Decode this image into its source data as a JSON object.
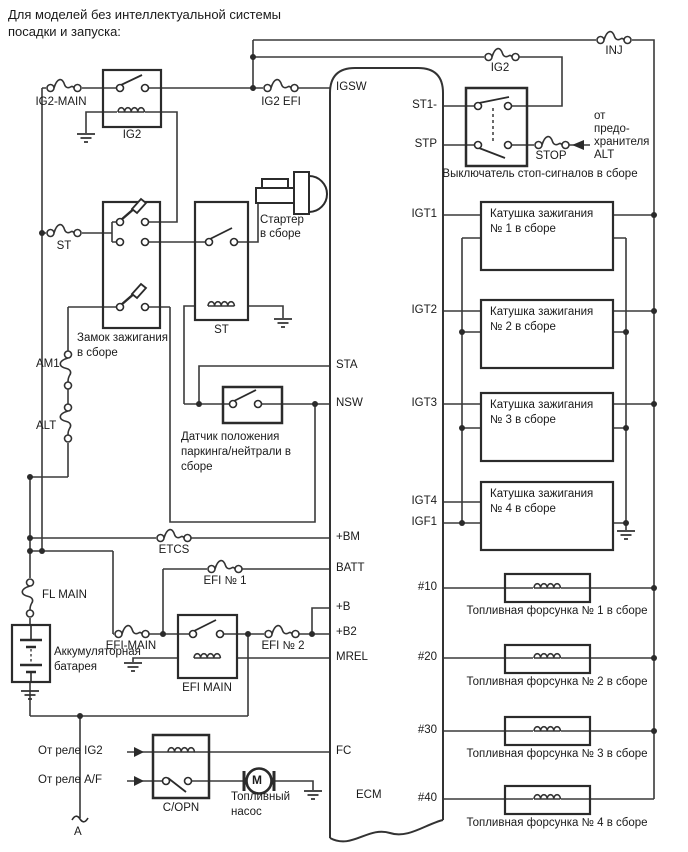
{
  "title": {
    "line1": "Для моделей без интеллектуальной системы",
    "line2": "посадки и запуска:"
  },
  "fuses": {
    "ig2_main": "IG2-MAIN",
    "ig2_efi": "IG2 EFI",
    "ig2_top": "IG2",
    "inj": "INJ",
    "stop": "STOP",
    "st": "ST",
    "am1": "AM1",
    "alt": "ALT",
    "etcs": "ETCS",
    "efi_no1": "EFI № 1",
    "efi_main": "EFI-MAIN",
    "efi_no2": "EFI № 2",
    "fl_main": "FL MAIN"
  },
  "relays": {
    "ig2": "IG2",
    "st": "ST",
    "efi_main": "EFI MAIN",
    "copn": "C/OPN"
  },
  "components": {
    "ignition_switch_l1": "Замок зажигания",
    "ignition_switch_l2": "в сборе",
    "starter_l1": "Стартер",
    "starter_l2": "в сборе",
    "park_neutral_l1": "Датчик положения",
    "park_neutral_l2": "паркинга/нейтрали в",
    "park_neutral_l3": "сборе",
    "battery_l1": "Аккумуляторная",
    "battery_l2": "батарея",
    "stop_switch": "Выключатель стоп-сигналов в сборе",
    "fuel_pump_l1": "Топливный",
    "fuel_pump_l2": "насос",
    "motor": "M",
    "from_ig2": "От реле IG2",
    "from_af": "От реле A/F",
    "alt_note_l1": "от",
    "alt_note_l2": "предо-",
    "alt_note_l3": "хранителя",
    "alt_note_l4": "ALT",
    "connector_a": "A"
  },
  "ecm": {
    "label": "ECM",
    "pins_left": [
      "IGSW",
      "STA",
      "NSW",
      "+BM",
      "BATT",
      "+B",
      "+B2",
      "MREL",
      "FC"
    ],
    "pins_right": [
      "ST1-",
      "STP",
      "IGT1",
      "IGT2",
      "IGT3",
      "IGT4",
      "IGF1",
      "#10",
      "#20",
      "#30",
      "#40"
    ]
  },
  "coils": [
    {
      "l1": "Катушка зажигания",
      "l2": "№ 1 в сборе"
    },
    {
      "l1": "Катушка зажигания",
      "l2": "№ 2 в сборе"
    },
    {
      "l1": "Катушка зажигания",
      "l2": "№ 3 в сборе"
    },
    {
      "l1": "Катушка зажигания",
      "l2": "№ 4 в сборе"
    }
  ],
  "injectors": [
    "Топливная форсунка № 1 в сборе",
    "Топливная форсунка № 2 в сборе",
    "Топливная форсунка № 3 в сборе",
    "Топливная форсунка № 4 в сборе"
  ]
}
